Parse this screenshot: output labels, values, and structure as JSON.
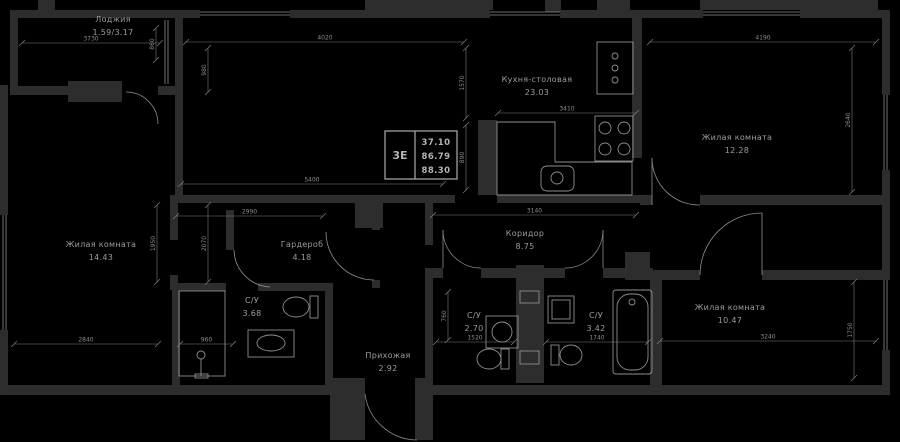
{
  "meta": {
    "title": "Floor plan 3E apartment"
  },
  "colors": {
    "background": "#000000",
    "wall": "#2d2d2d",
    "line": "#8f8f8f",
    "dim": "#7d7d7d",
    "text": "#9c9c9c",
    "stamp_border": "#a0a0a0"
  },
  "stamp": {
    "type": "3Е",
    "v1": "37.10",
    "v2": "86.79",
    "v3": "88.30",
    "x": 385,
    "y": 131,
    "w": 72,
    "h": 48,
    "div": 415
  },
  "rooms": [
    {
      "name": "Лоджия",
      "area": "1.59/3.17",
      "x": 113,
      "y": 22
    },
    {
      "name": "Кухня-столовая",
      "area": "23.03",
      "x": 537,
      "y": 82
    },
    {
      "name": "Жилая комната",
      "area": "12.28",
      "x": 737,
      "y": 140
    },
    {
      "name": "Жилая комната",
      "area": "14.43",
      "x": 101,
      "y": 247
    },
    {
      "name": "Гардероб",
      "area": "4.18",
      "x": 302,
      "y": 247
    },
    {
      "name": "С/У",
      "area": "3.68",
      "x": 252,
      "y": 303
    },
    {
      "name": "Коридор",
      "area": "8.75",
      "x": 525,
      "y": 236
    },
    {
      "name": "С/У",
      "area": "2.70",
      "x": 474,
      "y": 318
    },
    {
      "name": "С/У",
      "area": "3.42",
      "x": 596,
      "y": 318
    },
    {
      "name": "Жилая комната",
      "area": "10.47",
      "x": 730,
      "y": 310
    },
    {
      "name": "Прихожая",
      "area": "2.92",
      "x": 388,
      "y": 358
    }
  ],
  "walls": [
    [
      38,
      0,
      17,
      12
    ],
    [
      365,
      0,
      128,
      10
    ],
    [
      545,
      0,
      16,
      12
    ],
    [
      597,
      0,
      33,
      10
    ],
    [
      700,
      0,
      178,
      10
    ],
    [
      10,
      10,
      165,
      8
    ],
    [
      10,
      18,
      8,
      68
    ],
    [
      10,
      86,
      58,
      9
    ],
    [
      68,
      81,
      54,
      21
    ],
    [
      158,
      86,
      17,
      9
    ],
    [
      175,
      10,
      25,
      8
    ],
    [
      290,
      10,
      200,
      8
    ],
    [
      560,
      10,
      143,
      8
    ],
    [
      800,
      10,
      90,
      8
    ],
    [
      0,
      85,
      8,
      130
    ],
    [
      0,
      330,
      8,
      60
    ],
    [
      882,
      18,
      8,
      77
    ],
    [
      882,
      170,
      8,
      110
    ],
    [
      882,
      350,
      8,
      40
    ],
    [
      0,
      385,
      330,
      10
    ],
    [
      433,
      385,
      457,
      10
    ],
    [
      330,
      378,
      35,
      62
    ],
    [
      415,
      378,
      18,
      62
    ],
    [
      175,
      18,
      8,
      177
    ],
    [
      175,
      195,
      155,
      8
    ],
    [
      355,
      198,
      28,
      30
    ],
    [
      330,
      195,
      125,
      8
    ],
    [
      497,
      195,
      143,
      8
    ],
    [
      478,
      120,
      19,
      75
    ],
    [
      632,
      18,
      10,
      140
    ],
    [
      640,
      195,
      12,
      10
    ],
    [
      700,
      195,
      190,
      10
    ],
    [
      640,
      270,
      60,
      10
    ],
    [
      762,
      270,
      128,
      10
    ],
    [
      625,
      252,
      25,
      28
    ],
    [
      226,
      210,
      8,
      40
    ],
    [
      372,
      203,
      8,
      27
    ],
    [
      372,
      280,
      8,
      8
    ],
    [
      425,
      203,
      8,
      42
    ],
    [
      425,
      268,
      8,
      117
    ],
    [
      428,
      268,
      15,
      10
    ],
    [
      481,
      268,
      39,
      10
    ],
    [
      516,
      265,
      28,
      118
    ],
    [
      544,
      268,
      21,
      10
    ],
    [
      603,
      268,
      50,
      10
    ],
    [
      650,
      280,
      12,
      105
    ],
    [
      170,
      195,
      8,
      45
    ],
    [
      170,
      275,
      8,
      15
    ],
    [
      172,
      290,
      8,
      95
    ],
    [
      325,
      283,
      8,
      102
    ],
    [
      172,
      283,
      54,
      8
    ],
    [
      258,
      283,
      74,
      8
    ]
  ],
  "windows": [
    {
      "o": "h",
      "x": 200,
      "y": 12,
      "len": 90
    },
    {
      "o": "h",
      "x": 490,
      "y": 12,
      "len": 70
    },
    {
      "o": "h",
      "x": 703,
      "y": 12,
      "len": 97
    },
    {
      "o": "v",
      "x": 3,
      "y": 215,
      "len": 115
    },
    {
      "o": "v",
      "x": 884,
      "y": 95,
      "len": 75
    },
    {
      "o": "v",
      "x": 884,
      "y": 280,
      "len": 70
    },
    {
      "o": "v",
      "x": 165,
      "y": 20,
      "len": 64
    }
  ],
  "doors": [
    {
      "d": "M 126 92 A 32 32 0 0 1 158 124"
    },
    {
      "d": "M 326 232 A 48 48 0 0 0 374 280"
    },
    {
      "d": "M 443 230 A 38 38 0 0 0 481 268",
      "leaf": [
        443,
        230,
        443,
        268
      ]
    },
    {
      "d": "M 603 230 A 38 38 0 0 1 565 268",
      "leaf": [
        603,
        230,
        603,
        268
      ]
    },
    {
      "d": "M 652 158 A 47 47 0 0 0 700 205",
      "leaf": [
        652,
        158,
        652,
        205
      ]
    },
    {
      "d": "M 762 213 A 62 62 0 0 0 700 275",
      "leaf": [
        762,
        213,
        762,
        275
      ]
    },
    {
      "d": "M 365 394 A 53 53 0 0 0 417 440"
    },
    {
      "d": "M 234 250 A 38 38 0 0 0 270 287"
    }
  ],
  "fixtures": [
    {
      "n": "kitchen-counter",
      "t": "path",
      "a": {
        "d": "M497 122 L555 122 L555 162 L632 162 L632 195 L497 195 Z"
      }
    },
    {
      "n": "kitchen-sink",
      "t": "rect",
      "a": {
        "x": 541,
        "y": 166,
        "width": 33,
        "height": 25,
        "rx": 6
      }
    },
    {
      "n": "kitchen-sink-basin",
      "t": "circle",
      "a": {
        "cx": 557,
        "cy": 178,
        "r": 6
      }
    },
    {
      "n": "stove",
      "t": "rect",
      "a": {
        "x": 595,
        "y": 116,
        "width": 38,
        "height": 45
      }
    },
    {
      "n": "stove-burner",
      "t": "circle",
      "a": {
        "cx": 605,
        "cy": 128,
        "r": 6
      }
    },
    {
      "n": "stove-burner",
      "t": "circle",
      "a": {
        "cx": 624,
        "cy": 128,
        "r": 6
      }
    },
    {
      "n": "stove-burner",
      "t": "circle",
      "a": {
        "cx": 605,
        "cy": 149,
        "r": 6
      }
    },
    {
      "n": "stove-burner",
      "t": "circle",
      "a": {
        "cx": 624,
        "cy": 149,
        "r": 6
      }
    },
    {
      "n": "fridge",
      "t": "rect",
      "a": {
        "x": 597,
        "y": 42,
        "width": 36,
        "height": 52
      }
    },
    {
      "n": "fridge-knob",
      "t": "circle",
      "a": {
        "cx": 615,
        "cy": 56,
        "r": 3
      }
    },
    {
      "n": "fridge-knob",
      "t": "circle",
      "a": {
        "cx": 615,
        "cy": 68,
        "r": 3
      }
    },
    {
      "n": "fridge-knob",
      "t": "circle",
      "a": {
        "cx": 615,
        "cy": 80,
        "r": 3
      }
    },
    {
      "n": "shower-stall",
      "t": "rect",
      "a": {
        "x": 179,
        "y": 291,
        "width": 46,
        "height": 85
      }
    },
    {
      "n": "shower-head",
      "t": "circle",
      "a": {
        "cx": 201,
        "cy": 355,
        "r": 4
      }
    },
    {
      "n": "shower-stand",
      "t": "line",
      "a": {
        "x1": 201,
        "y1": 359,
        "x2": 201,
        "y2": 376
      }
    },
    {
      "n": "shower-base",
      "t": "rect",
      "a": {
        "x": 195,
        "y": 374,
        "width": 13,
        "height": 4
      }
    },
    {
      "n": "toilet-bowl",
      "t": "ellipse",
      "a": {
        "cx": 296,
        "cy": 307,
        "rx": 13,
        "ry": 10
      }
    },
    {
      "n": "toilet-tank",
      "t": "rect",
      "a": {
        "x": 310,
        "y": 296,
        "width": 8,
        "height": 22
      }
    },
    {
      "n": "vanity",
      "t": "rect",
      "a": {
        "x": 248,
        "y": 330,
        "width": 46,
        "height": 27
      }
    },
    {
      "n": "vanity-basin",
      "t": "ellipse",
      "a": {
        "cx": 271,
        "cy": 343,
        "rx": 14,
        "ry": 8
      }
    },
    {
      "n": "washbasin-cabinet",
      "t": "rect",
      "a": {
        "x": 486,
        "y": 316,
        "width": 32,
        "height": 32
      }
    },
    {
      "n": "washbasin",
      "t": "circle",
      "a": {
        "cx": 502,
        "cy": 332,
        "r": 10
      }
    },
    {
      "n": "toilet-bowl",
      "t": "ellipse",
      "a": {
        "cx": 489,
        "cy": 359,
        "rx": 12,
        "ry": 10
      }
    },
    {
      "n": "toilet-tank",
      "t": "rect",
      "a": {
        "x": 501,
        "y": 349,
        "width": 8,
        "height": 20
      }
    },
    {
      "n": "sink",
      "t": "rect",
      "a": {
        "x": 548,
        "y": 296,
        "width": 26,
        "height": 27
      }
    },
    {
      "n": "sink-inner",
      "t": "rect",
      "a": {
        "x": 552,
        "y": 300,
        "width": 18,
        "height": 19
      }
    },
    {
      "n": "toilet-tank",
      "t": "rect",
      "a": {
        "x": 551,
        "y": 345,
        "width": 8,
        "height": 20
      }
    },
    {
      "n": "toilet-bowl",
      "t": "ellipse",
      "a": {
        "cx": 571,
        "cy": 355,
        "rx": 11,
        "ry": 10
      }
    },
    {
      "n": "bathtub",
      "t": "rect",
      "a": {
        "x": 613,
        "y": 290,
        "width": 39,
        "height": 84,
        "rx": 3
      }
    },
    {
      "n": "bathtub-inner",
      "t": "rect",
      "a": {
        "x": 617,
        "y": 294,
        "width": 31,
        "height": 76,
        "rx": 13
      }
    },
    {
      "n": "bathtub-drain",
      "t": "circle",
      "a": {
        "cx": 632,
        "cy": 302,
        "r": 3
      }
    },
    {
      "n": "washing-machine",
      "t": "rect",
      "a": {
        "x": 520,
        "y": 291,
        "width": 19,
        "height": 12
      }
    },
    {
      "n": "washing-machine",
      "t": "rect",
      "a": {
        "x": 520,
        "y": 351,
        "width": 19,
        "height": 13
      }
    }
  ],
  "dims": [
    {
      "t": "3730",
      "x1": 22,
      "y1": 43,
      "x2": 160,
      "y2": 43
    },
    {
      "t": "4020",
      "x1": 186,
      "y1": 42,
      "x2": 464,
      "y2": 42
    },
    {
      "t": "4190",
      "x1": 650,
      "y1": 42,
      "x2": 876,
      "y2": 42
    },
    {
      "t": "3410",
      "x1": 498,
      "y1": 113,
      "x2": 636,
      "y2": 113
    },
    {
      "t": "5400",
      "x1": 181,
      "y1": 184,
      "x2": 443,
      "y2": 184
    },
    {
      "t": "2990",
      "x1": 176,
      "y1": 216,
      "x2": 323,
      "y2": 216
    },
    {
      "t": "3140",
      "x1": 433,
      "y1": 215,
      "x2": 636,
      "y2": 215
    },
    {
      "t": "2840",
      "x1": 14,
      "y1": 344,
      "x2": 158,
      "y2": 344
    },
    {
      "t": "960",
      "x1": 180,
      "y1": 344,
      "x2": 233,
      "y2": 344
    },
    {
      "t": "1520",
      "x1": 436,
      "y1": 342,
      "x2": 514,
      "y2": 342
    },
    {
      "t": "1740",
      "x1": 546,
      "y1": 342,
      "x2": 648,
      "y2": 342
    },
    {
      "t": "3240",
      "x1": 660,
      "y1": 341,
      "x2": 876,
      "y2": 341
    },
    {
      "t": "860",
      "x1": 156,
      "y1": 28,
      "x2": 156,
      "y2": 60
    },
    {
      "t": "980",
      "x1": 208,
      "y1": 48,
      "x2": 208,
      "y2": 92
    },
    {
      "t": "1570",
      "x1": 466,
      "y1": 48,
      "x2": 466,
      "y2": 118
    },
    {
      "t": "890",
      "x1": 466,
      "y1": 125,
      "x2": 466,
      "y2": 190
    },
    {
      "t": "1950",
      "x1": 157,
      "y1": 205,
      "x2": 157,
      "y2": 282
    },
    {
      "t": "2070",
      "x1": 208,
      "y1": 205,
      "x2": 208,
      "y2": 282
    },
    {
      "t": "2640",
      "x1": 852,
      "y1": 48,
      "x2": 852,
      "y2": 192
    },
    {
      "t": "1750",
      "x1": 854,
      "y1": 282,
      "x2": 854,
      "y2": 378
    },
    {
      "t": "760",
      "x1": 448,
      "y1": 292,
      "x2": 448,
      "y2": 340
    }
  ]
}
